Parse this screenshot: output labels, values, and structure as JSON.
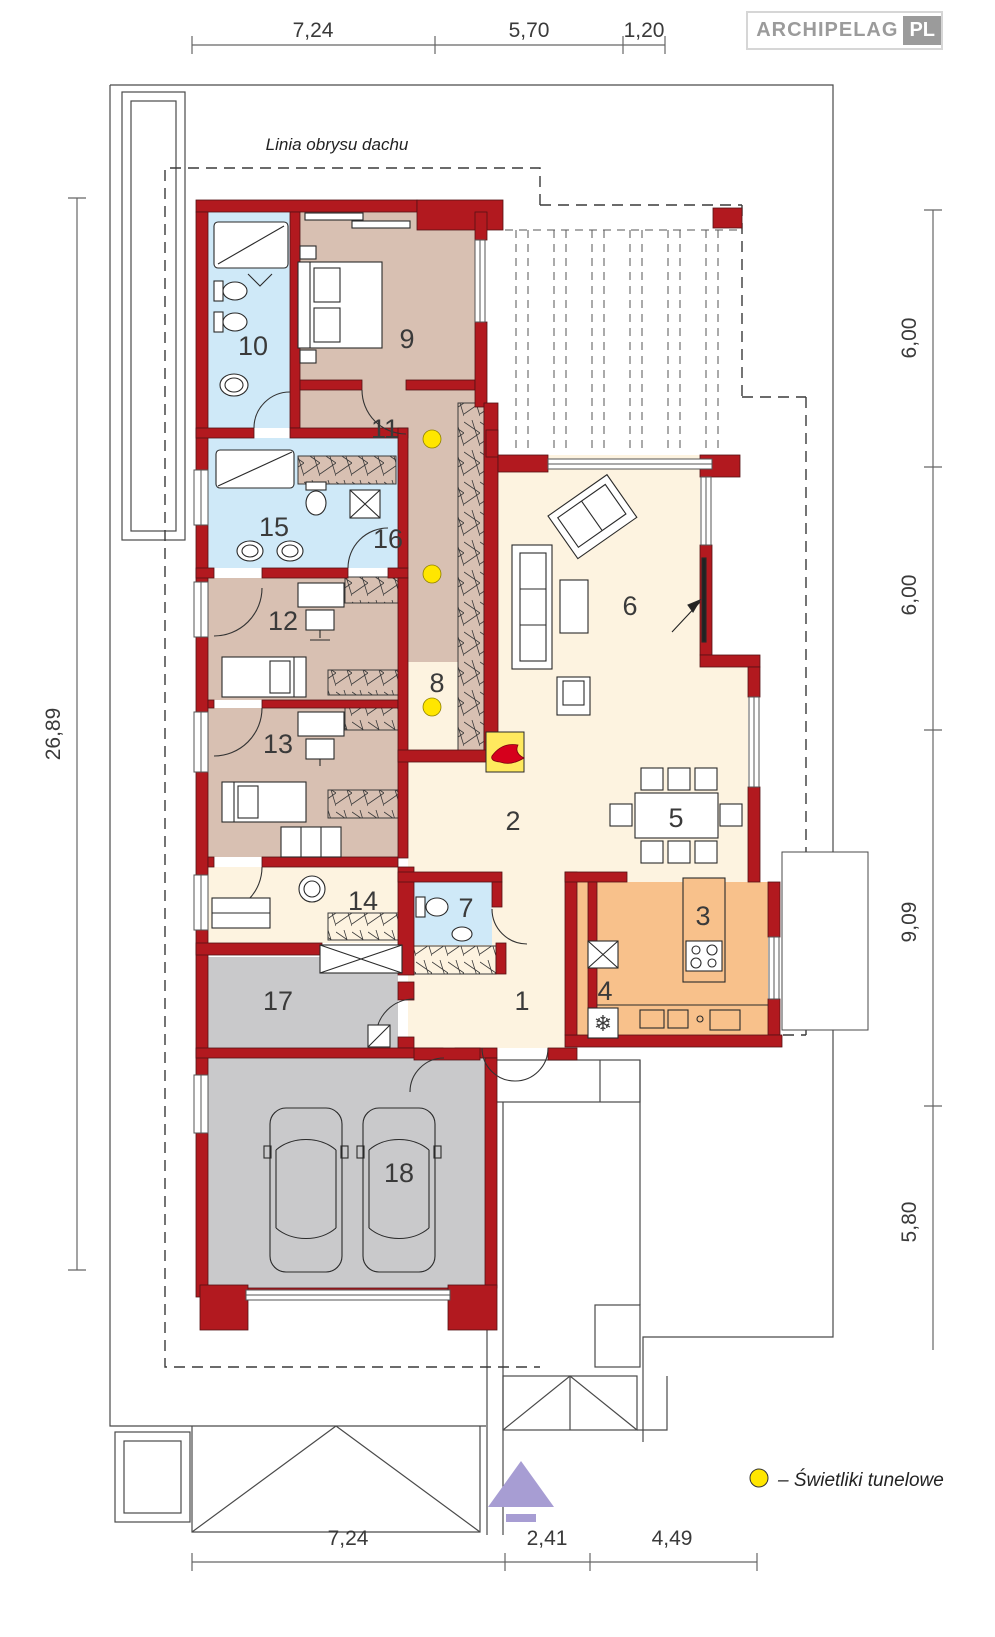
{
  "brand": {
    "name": "ARCHIPELAG",
    "tld": "PL"
  },
  "annotations": {
    "roof_outline": "Linia obrysu dachu"
  },
  "legend": {
    "symbol": "skylight-dot",
    "label": "– Świetliki tunelowe"
  },
  "room_numbers": [
    "1",
    "2",
    "3",
    "4",
    "5",
    "6",
    "7",
    "8",
    "9",
    "10",
    "11",
    "12",
    "13",
    "14",
    "15",
    "16",
    "17",
    "18"
  ],
  "dimensions": {
    "top": [
      "7,24",
      "5,70",
      "1,20"
    ],
    "right": [
      "6,00",
      "6,00",
      "9,09",
      "5,80"
    ],
    "bottom": [
      "7,24",
      "2,41",
      "4,49"
    ],
    "left": [
      "26,89"
    ]
  },
  "icons": {
    "fridge": "❄"
  },
  "colors": {
    "wall": "#b2191f",
    "bedroom_floor": "#d8c0b2",
    "bath_floor": "#cfe9f8",
    "living_floor": "#fdf3e0",
    "kitchen_floor": "#f8c18b",
    "garage_floor": "#c9c9cb",
    "skylight": "#ffe600",
    "fireplace": "#ffe95e",
    "flame": "#d6001c",
    "north_arrow": "#a79dd3"
  }
}
